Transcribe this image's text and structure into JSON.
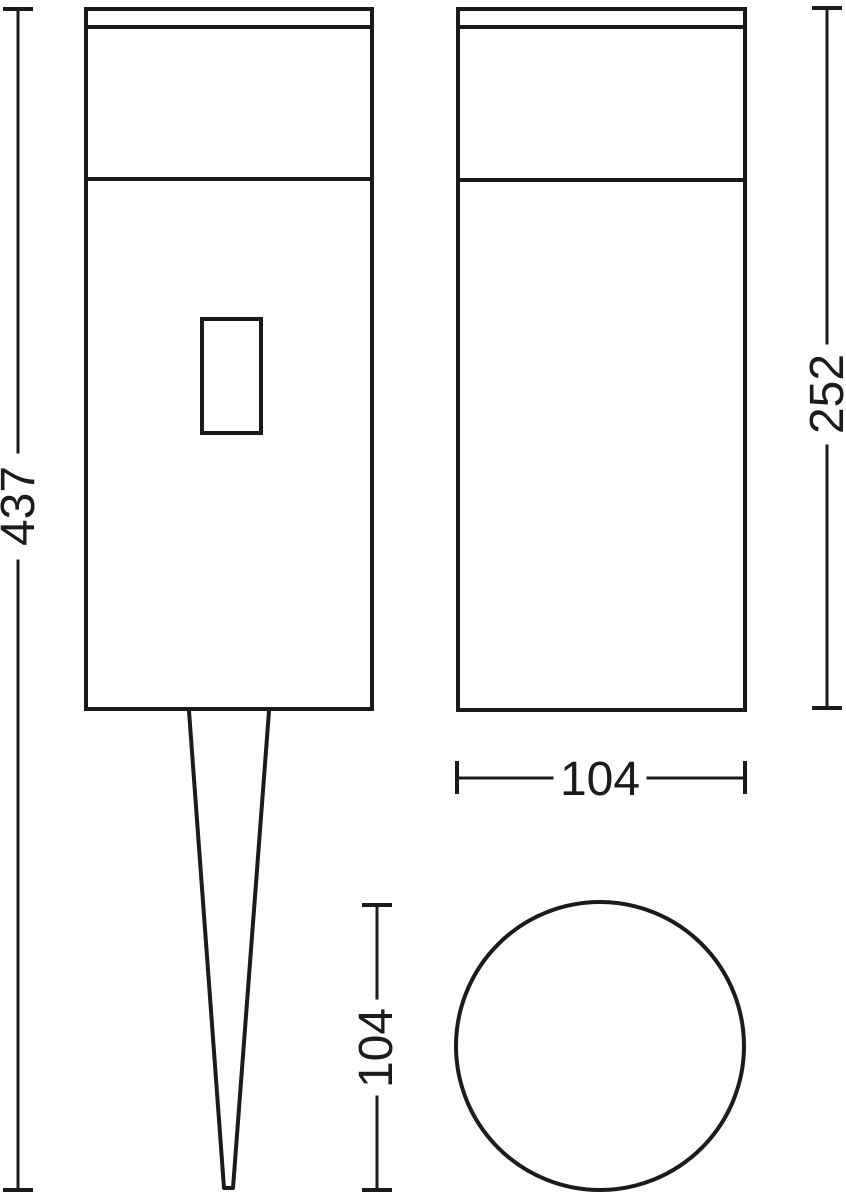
{
  "canvas": {
    "background_color": "#ffffff",
    "line_color": "#1b1b1b"
  },
  "dimensions": {
    "total_height": "437",
    "housing_height": "252",
    "housing_width": "104",
    "housing_diameter": "104"
  }
}
